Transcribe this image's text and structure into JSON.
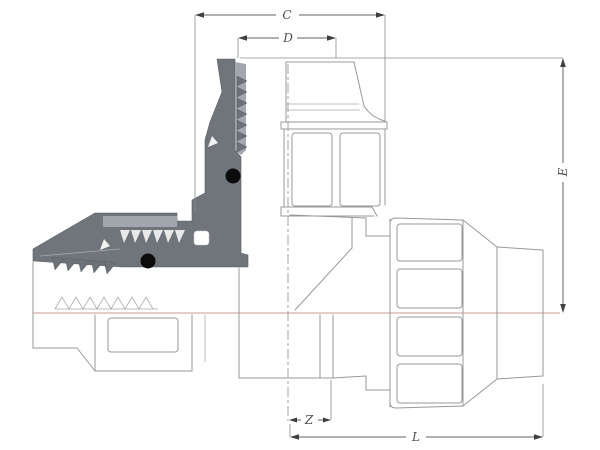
{
  "drawing": {
    "type": "technical-drawing",
    "subject": "compression tee pipe fitting with cutaway section view",
    "dimensions": {
      "c": "C",
      "d": "D",
      "e": "E",
      "z": "Z",
      "l": "L"
    },
    "colors": {
      "background": "#ffffff",
      "outline_gray": "#97999c",
      "section_fill": "#70757c",
      "section_light": "#a2a7ad",
      "oring_black": "#0c0c0c",
      "centerline_pink": "#c89b90",
      "dimension_gray": "#616161"
    }
  }
}
